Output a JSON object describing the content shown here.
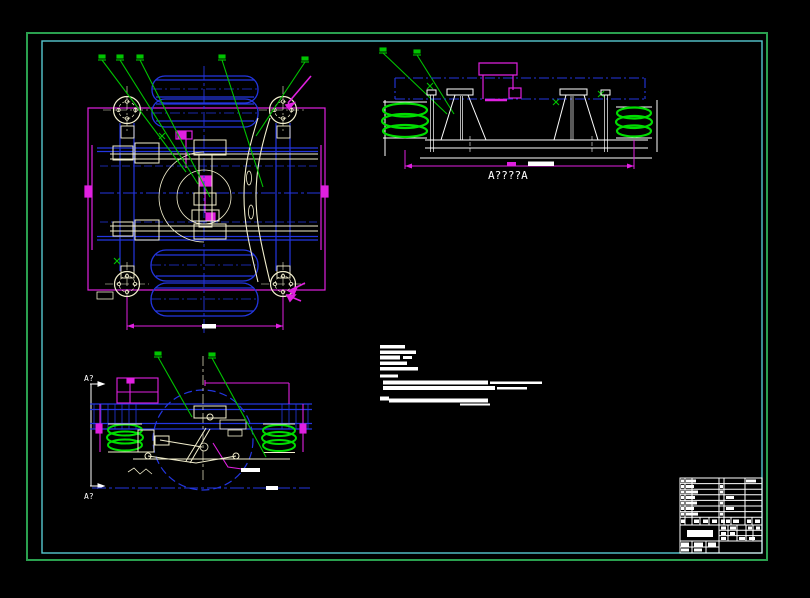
{
  "canvas": {
    "width": 810,
    "height": 598,
    "background": "#000000"
  },
  "frame": {
    "outer_border_color": "#2aa04f",
    "inner_border_color": "#55c8d0"
  },
  "palette": {
    "blue": "#2336e0",
    "magenta": "#e020e0",
    "green": "#00c400",
    "bright_green": "#00dd00",
    "cream": "#f2eecd",
    "white": "#ffffff"
  },
  "views": {
    "section_view": {
      "label": "A????A"
    },
    "side_view": {
      "marker_top": "A?",
      "marker_bottom": "A?"
    }
  }
}
